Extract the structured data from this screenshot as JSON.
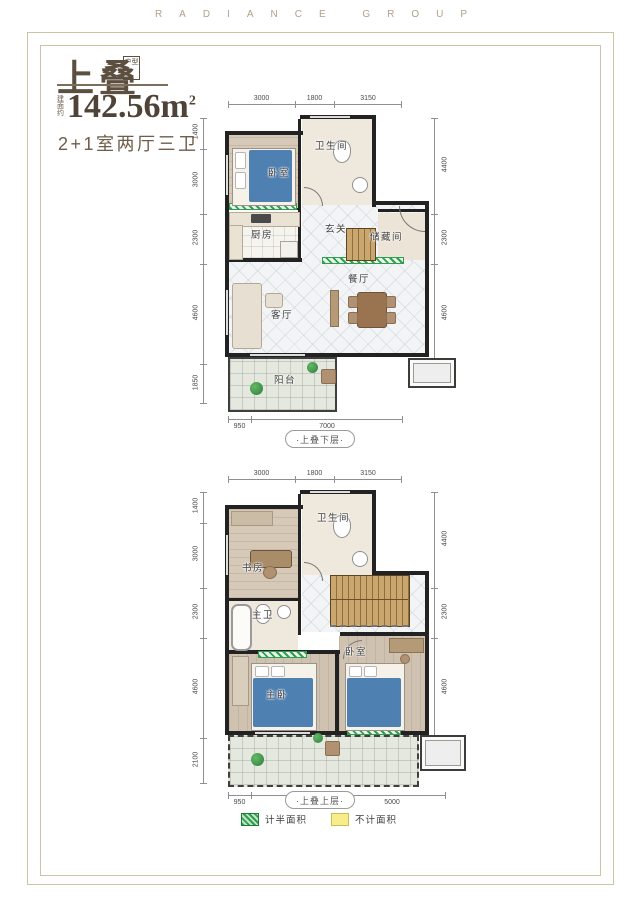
{
  "brand": {
    "letters": "RADIANCE GROUP"
  },
  "header": {
    "title": "上叠",
    "title_tag": "户型",
    "area_prefix": "建面约",
    "area_value": "142.56",
    "area_unit": "m",
    "area_exp": "2",
    "spec": "2+1室两厅三卫"
  },
  "plans": [
    {
      "caption": "·上叠下层·",
      "dims_top": [
        "3000",
        "1800",
        "3150"
      ],
      "dims_left": [
        "1400",
        "3000",
        "2300",
        "4600",
        "1850"
      ],
      "dims_right": [
        "4400",
        "2300",
        "4600"
      ],
      "dims_bottom": [
        "950",
        "7000"
      ],
      "rooms": {
        "bedroom": "卧室",
        "bathroom": "卫生间",
        "foyer": "玄关",
        "kitchen": "厨房",
        "storage": "储藏间",
        "dining": "餐厅",
        "living": "客厅",
        "balcony": "阳台"
      }
    },
    {
      "caption": "·上叠上层·",
      "dims_top": [
        "3000",
        "1800",
        "3150"
      ],
      "dims_left": [
        "1400",
        "3000",
        "2300",
        "4600",
        "2100"
      ],
      "dims_right": [
        "4400",
        "2300",
        "4600"
      ],
      "dims_bottom": [
        "950",
        "4000",
        "5000"
      ],
      "rooms": {
        "study": "书房",
        "bathroom": "卫生间",
        "master_bath": "主卫",
        "master_bedroom": "主卧",
        "bedroom": "卧室"
      }
    }
  ],
  "legend": {
    "items": [
      {
        "label": "计半面积",
        "color": "#2f9e4f"
      },
      {
        "label": "不计面积",
        "color": "#f7ee8b"
      }
    ]
  },
  "colors": {
    "frame": "#cfc2a6",
    "brand_text": "#b0a089",
    "title_text": "#5c4f40",
    "wall": "#222222",
    "half_area_green": "#2f9e4f",
    "excluded_yellow": "#f7ee8b"
  }
}
